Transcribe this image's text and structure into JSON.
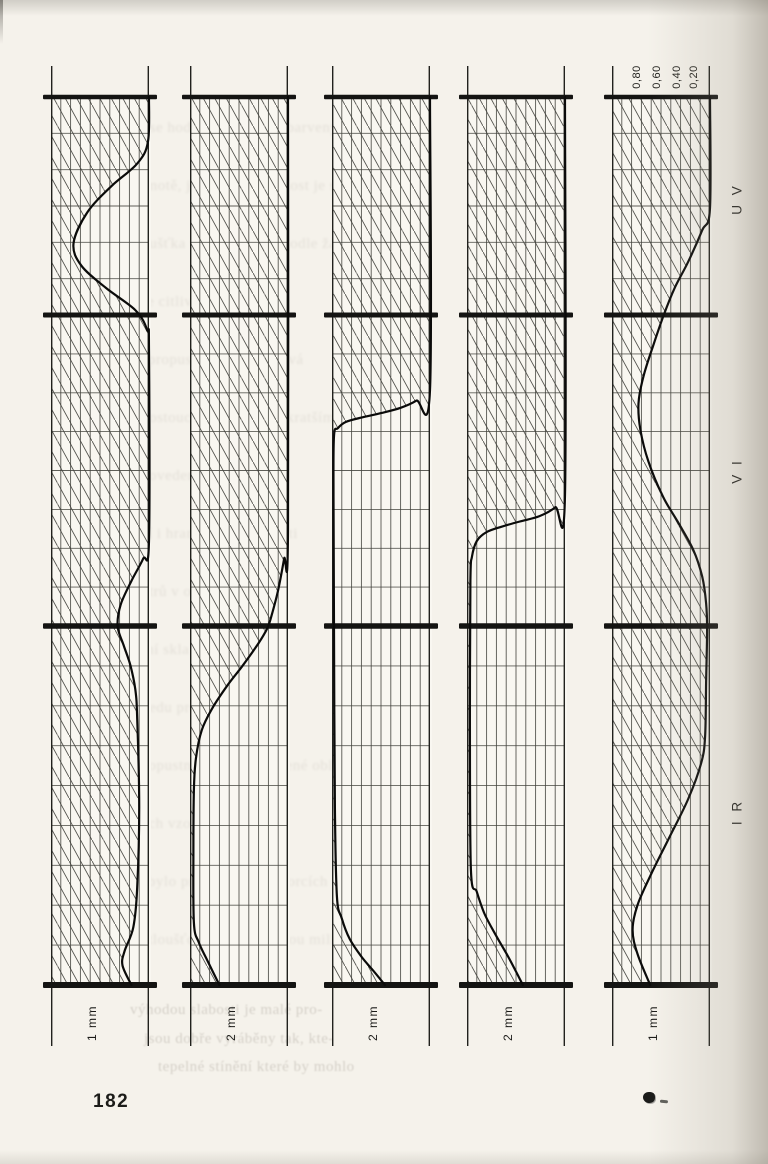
{
  "page": {
    "number": "182"
  },
  "chart_data": {
    "type": "area",
    "description_orientation": "five vertical strip diagrams, spectral axis runs top to bottom (UV to VI to IR), value axis runs right-to-left from 0.00 at right edge to 1.00 at left edge; hatched area lies between the left edge and each curve",
    "value_axis": {
      "ticks": [
        "0,80",
        "0,60",
        "0,40",
        "0,20"
      ],
      "tick_values": [
        0.8,
        0.6,
        0.4,
        0.2
      ],
      "min": 0.0,
      "max": 1.0,
      "left_edge_value": 1.0,
      "right_edge_value": 0.0,
      "grid_divisions": 10
    },
    "spectral_bands": [
      "U V",
      "V I",
      "I R"
    ],
    "strips": [
      {
        "label": "1 mm",
        "points": [
          [
            0,
            0
          ],
          [
            0.05,
            0.01
          ],
          [
            0.075,
            0.12
          ],
          [
            0.1,
            0.38
          ],
          [
            0.13,
            0.63
          ],
          [
            0.165,
            0.77
          ],
          [
            0.19,
            0.69
          ],
          [
            0.215,
            0.44
          ],
          [
            0.24,
            0.14
          ],
          [
            0.262,
            0.02
          ],
          [
            0.285,
            0
          ],
          [
            0.5,
            0
          ],
          [
            0.52,
            0.06
          ],
          [
            0.545,
            0.18
          ],
          [
            0.572,
            0.29
          ],
          [
            0.596,
            0.32
          ],
          [
            0.617,
            0.26
          ],
          [
            0.64,
            0.19
          ],
          [
            0.667,
            0.14
          ],
          [
            0.7,
            0.12
          ],
          [
            0.8,
            0.1
          ],
          [
            0.89,
            0.12
          ],
          [
            0.935,
            0.16
          ],
          [
            0.962,
            0.25
          ],
          [
            0.978,
            0.27
          ],
          [
            1,
            0.18
          ]
        ]
      },
      {
        "label": "2 mm",
        "points": [
          [
            0,
            0
          ],
          [
            0.49,
            0
          ],
          [
            0.52,
            0.04
          ],
          [
            0.555,
            0.1
          ],
          [
            0.585,
            0.17
          ],
          [
            0.598,
            0.21
          ],
          [
            0.615,
            0.3
          ],
          [
            0.64,
            0.46
          ],
          [
            0.663,
            0.62
          ],
          [
            0.688,
            0.77
          ],
          [
            0.713,
            0.88
          ],
          [
            0.745,
            0.94
          ],
          [
            0.78,
            0.96
          ],
          [
            0.85,
            0.965
          ],
          [
            0.93,
            0.96
          ],
          [
            0.952,
            0.91
          ],
          [
            0.973,
            0.82
          ],
          [
            1,
            0.7
          ]
        ]
      },
      {
        "label": "2 mm",
        "points": [
          [
            0,
            0
          ],
          [
            0.33,
            0
          ],
          [
            0.342,
            0.14
          ],
          [
            0.35,
            0.3
          ],
          [
            0.356,
            0.5
          ],
          [
            0.361,
            0.7
          ],
          [
            0.366,
            0.86
          ],
          [
            0.373,
            0.94
          ],
          [
            0.382,
            0.98
          ],
          [
            0.45,
            0.985
          ],
          [
            0.6,
            0.98
          ],
          [
            0.8,
            0.97
          ],
          [
            0.9,
            0.95
          ],
          [
            0.925,
            0.9
          ],
          [
            0.948,
            0.82
          ],
          [
            0.968,
            0.7
          ],
          [
            0.985,
            0.57
          ],
          [
            1,
            0.46
          ]
        ]
      },
      {
        "label": "2 mm",
        "points": [
          [
            0,
            0
          ],
          [
            0.448,
            0
          ],
          [
            0.462,
            0.1
          ],
          [
            0.472,
            0.26
          ],
          [
            0.478,
            0.46
          ],
          [
            0.484,
            0.65
          ],
          [
            0.49,
            0.8
          ],
          [
            0.5,
            0.9
          ],
          [
            0.518,
            0.95
          ],
          [
            0.545,
            0.965
          ],
          [
            0.7,
            0.97
          ],
          [
            0.87,
            0.96
          ],
          [
            0.895,
            0.9
          ],
          [
            0.92,
            0.82
          ],
          [
            0.945,
            0.7
          ],
          [
            0.97,
            0.57
          ],
          [
            1,
            0.43
          ]
        ]
      },
      {
        "label": "1 mm",
        "points": [
          [
            0,
            0
          ],
          [
            0.125,
            0
          ],
          [
            0.15,
            0.08
          ],
          [
            0.185,
            0.22
          ],
          [
            0.215,
            0.36
          ],
          [
            0.245,
            0.47
          ],
          [
            0.28,
            0.58
          ],
          [
            0.315,
            0.68
          ],
          [
            0.345,
            0.73
          ],
          [
            0.375,
            0.71
          ],
          [
            0.41,
            0.63
          ],
          [
            0.45,
            0.48
          ],
          [
            0.48,
            0.32
          ],
          [
            0.51,
            0.17
          ],
          [
            0.54,
            0.08
          ],
          [
            0.57,
            0.04
          ],
          [
            0.6,
            0.03
          ],
          [
            0.66,
            0.04
          ],
          [
            0.72,
            0.05
          ],
          [
            0.75,
            0.09
          ],
          [
            0.79,
            0.22
          ],
          [
            0.835,
            0.42
          ],
          [
            0.875,
            0.6
          ],
          [
            0.91,
            0.74
          ],
          [
            0.938,
            0.79
          ],
          [
            0.965,
            0.74
          ],
          [
            1,
            0.61
          ]
        ]
      }
    ]
  },
  "ghost_text": {
    "lines": [
      "pro fotografii se hodí filtry ze skel barvených",
      "v celé hmotě, jejichž propustnost je stálá",
      "tloušťka vrstvy se volí podle žádaného",
      "účinku a podle citlivosti materiálu",
      "hranice propustnosti se posouvá",
      "s rostoucí tloušťkou ke kratším vlnám",
      "nejrůznější provedení zachovává",
      "zbarvení i hranice propustnosti",
      "filtrů v optické kvalitě",
      "zlaté zabarvení skla je patrné",
      "při pohledu proti světlu",
      "propustnost v infračervené oblasti",
      "zůstává u všech vzorků značná",
      "měření bylo provedeno na vzorcích",
      "o tloušťce jednoho a dvou milimetrů",
      "výhodou slabosti je malé pro-",
      "jsou dobře vyráběny tak, kte-",
      "tepelné stínění které by mohlo"
    ]
  }
}
